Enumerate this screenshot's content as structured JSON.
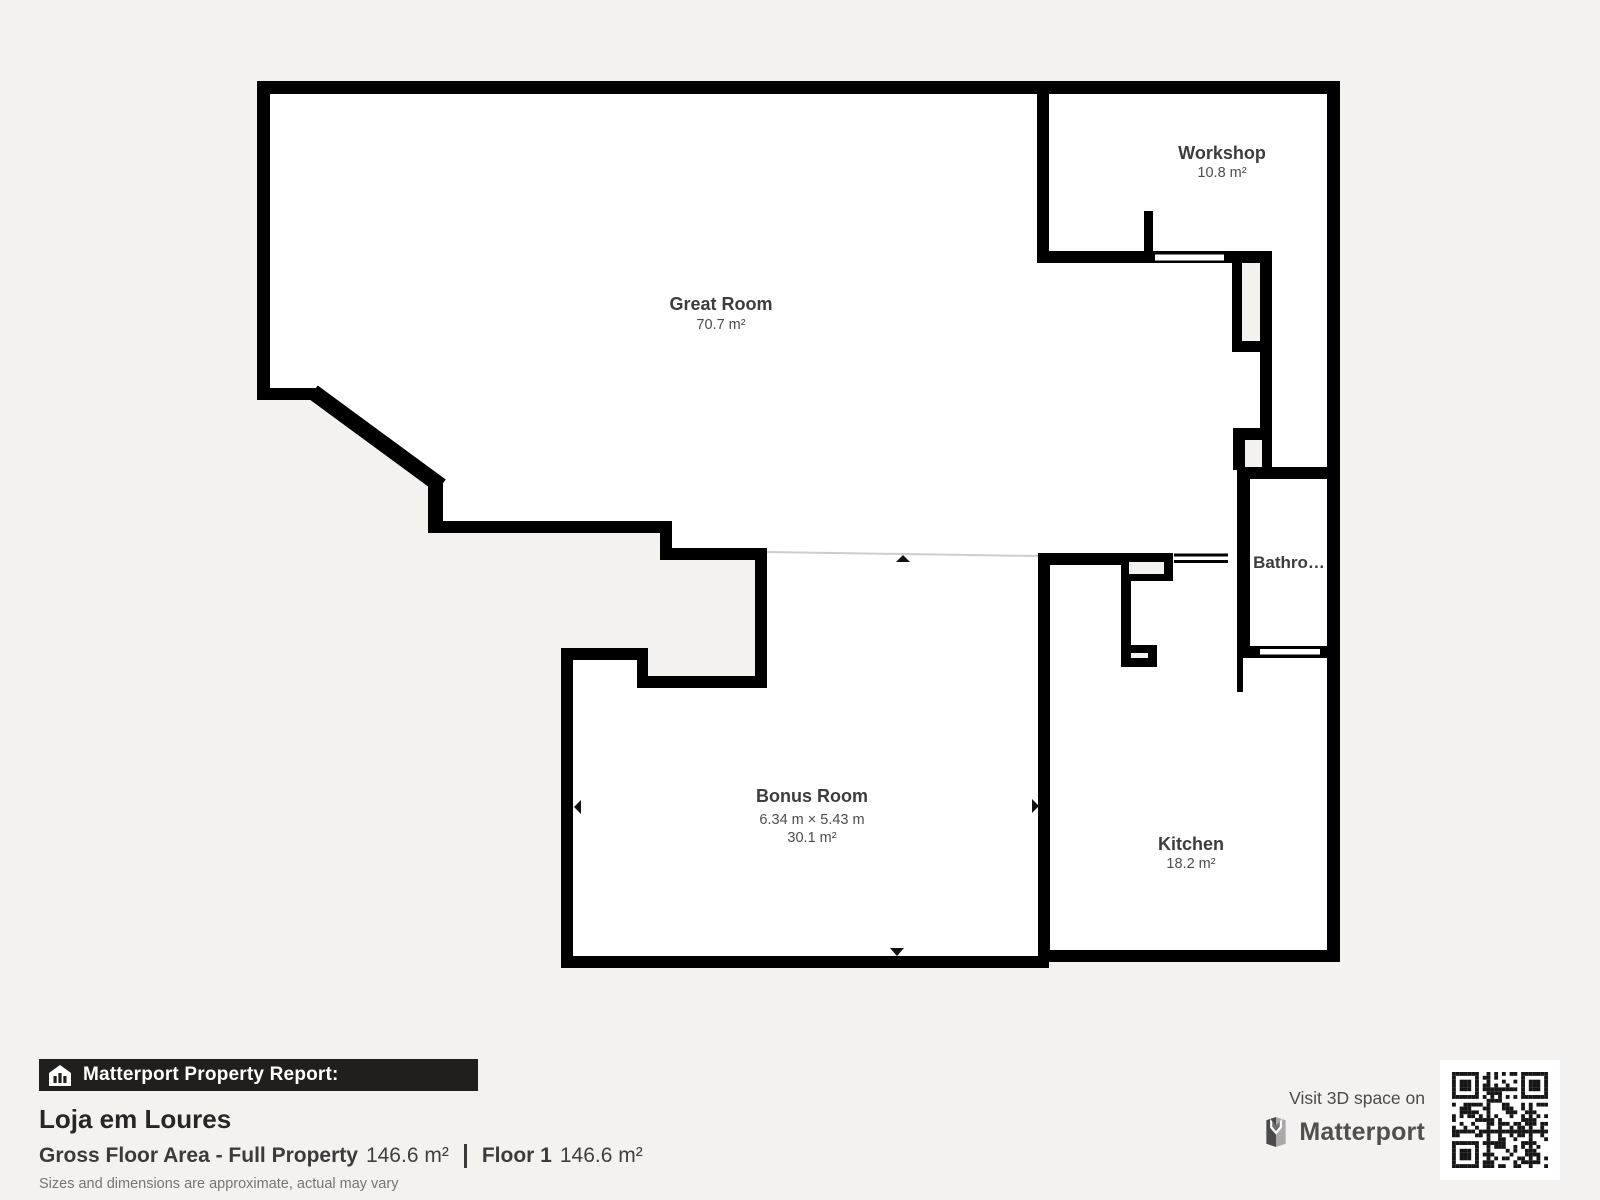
{
  "plan": {
    "rooms": [
      {
        "id": "great-room",
        "name": "Great Room",
        "area": "70.7 m²"
      },
      {
        "id": "workshop",
        "name": "Workshop",
        "area": "10.8 m²"
      },
      {
        "id": "bathroom",
        "name": "Bathro…"
      },
      {
        "id": "bonus-room",
        "name": "Bonus Room",
        "dims": "6.34 m × 5.43 m",
        "area": "30.1 m²"
      },
      {
        "id": "kitchen",
        "name": "Kitchen",
        "area": "18.2 m²"
      }
    ]
  },
  "report": {
    "badge": "Matterport Property Report:",
    "property_name": "Loja em Loures",
    "gross_label": "Gross Floor Area - Full Property",
    "gross_value": "146.6 m²",
    "floor_label": "Floor 1",
    "floor_value": "146.6 m²",
    "disclaimer": "Sizes and dimensions are approximate, actual may vary"
  },
  "promo": {
    "visit": "Visit 3D space on",
    "brand": "Matterport"
  },
  "colors": {
    "background": "#f4f2ef",
    "wall": "#000000",
    "floor": "#ffffff",
    "label_text": "#3d3d3d"
  }
}
